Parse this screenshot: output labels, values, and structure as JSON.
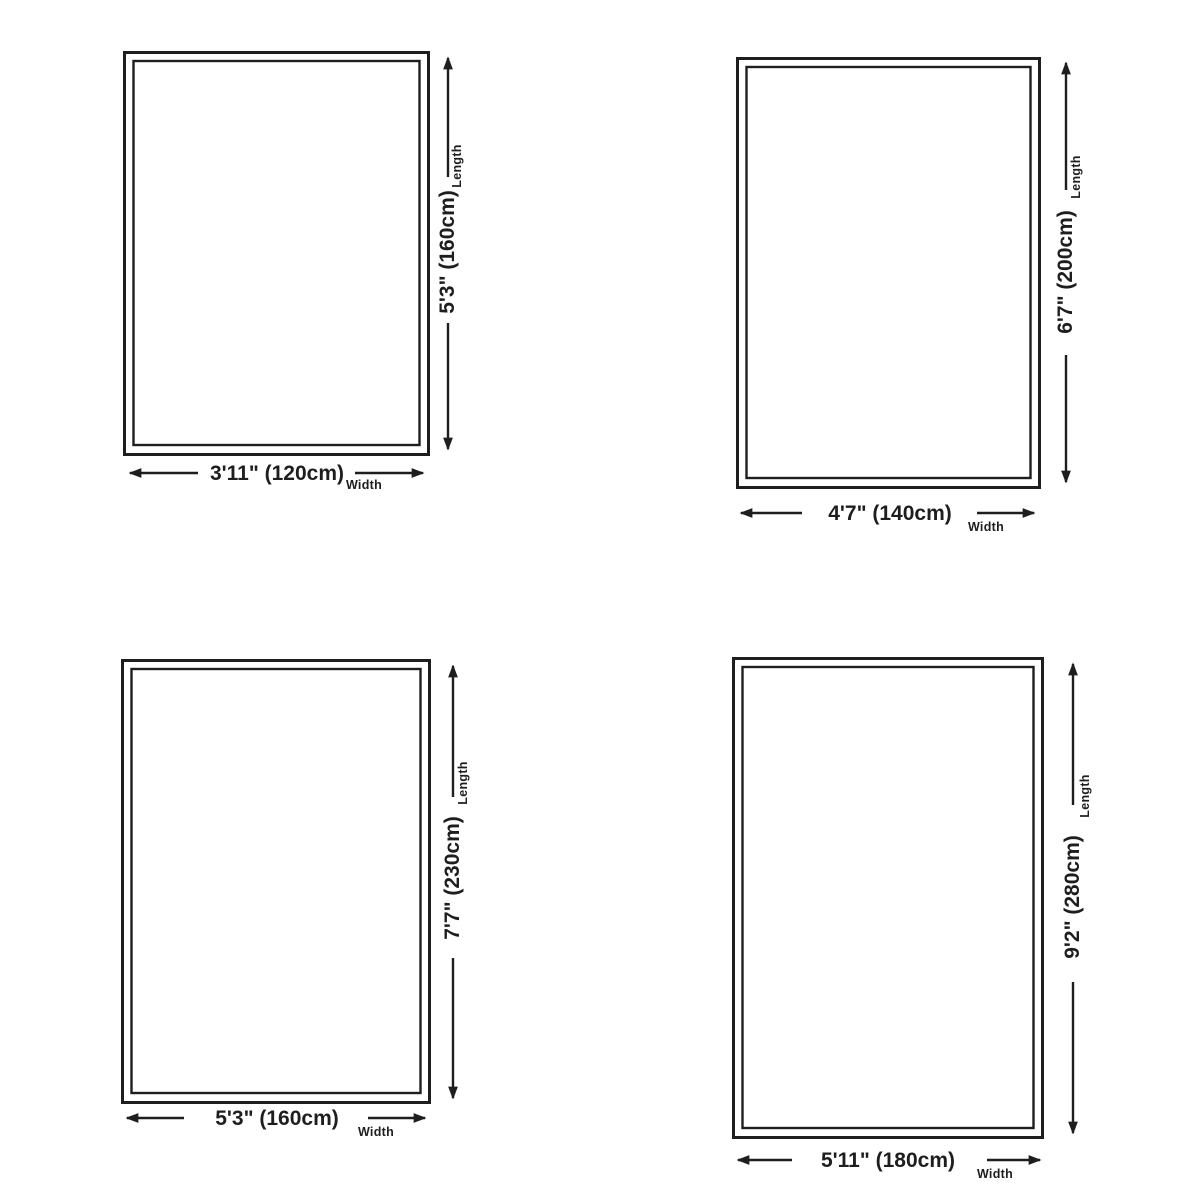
{
  "colors": {
    "ink": "#1e1e1e",
    "background": "#ffffff"
  },
  "captions": {
    "length": "Length",
    "width": "Width"
  },
  "panels": [
    {
      "name": "rug-size-120x160",
      "width_label": "3'11\" (120cm)",
      "length_label": "5'3\" (160cm)",
      "width_cm": 120,
      "length_cm": 160
    },
    {
      "name": "rug-size-140x200",
      "width_label": "4'7\" (140cm)",
      "length_label": "6'7\" (200cm)",
      "width_cm": 140,
      "length_cm": 200
    },
    {
      "name": "rug-size-160x230",
      "width_label": "5'3\" (160cm)",
      "length_label": "7'7\" (230cm)",
      "width_cm": 160,
      "length_cm": 230
    },
    {
      "name": "rug-size-180x280",
      "width_label": "5'11\" (180cm)",
      "length_label": "9'2\" (280cm)",
      "width_cm": 180,
      "length_cm": 280
    }
  ]
}
